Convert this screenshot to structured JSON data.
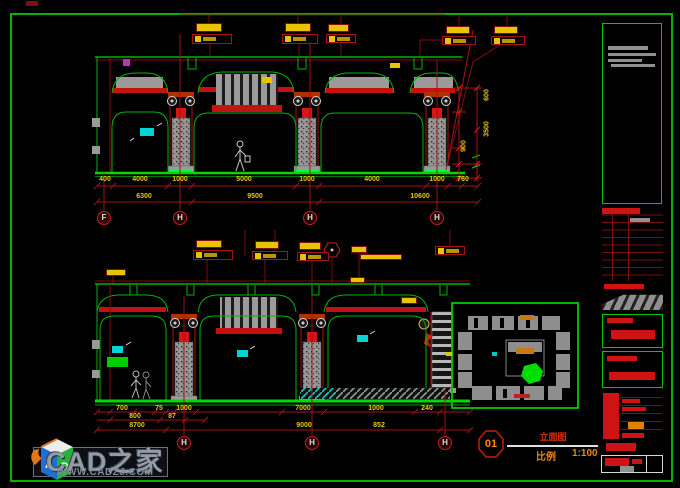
{
  "sheet": {
    "bg": "#000000",
    "border_color": "#00b400"
  },
  "title_bar": {
    "number": "01",
    "title": "立面图",
    "scale_label": "比例",
    "scale_value": "1:100"
  },
  "watermark": {
    "brand": "CAD之家",
    "url": "WWW.CADZJ.COM",
    "logo_a": "A",
    "logo_d": "D"
  },
  "top_elevation": {
    "dims_row1": [
      "400",
      "4000",
      "1000",
      "5000",
      "1000",
      "4000",
      "1000",
      "760"
    ],
    "dims_row2": [
      "6300",
      "9500",
      "10600"
    ],
    "vert_dims": [
      "600",
      "3500",
      "900"
    ],
    "grid_bubbles": [
      "F",
      "H",
      "H",
      "H"
    ]
  },
  "bottom_elevation": {
    "dims_row1": [
      "700",
      "75",
      "1000",
      "7000",
      "1000",
      "240"
    ],
    "dims_row2": [
      "800",
      "87"
    ],
    "dims_row3": [
      "8700",
      "9000",
      "852"
    ],
    "grid_bubbles": [
      "H",
      "H",
      "H"
    ]
  }
}
